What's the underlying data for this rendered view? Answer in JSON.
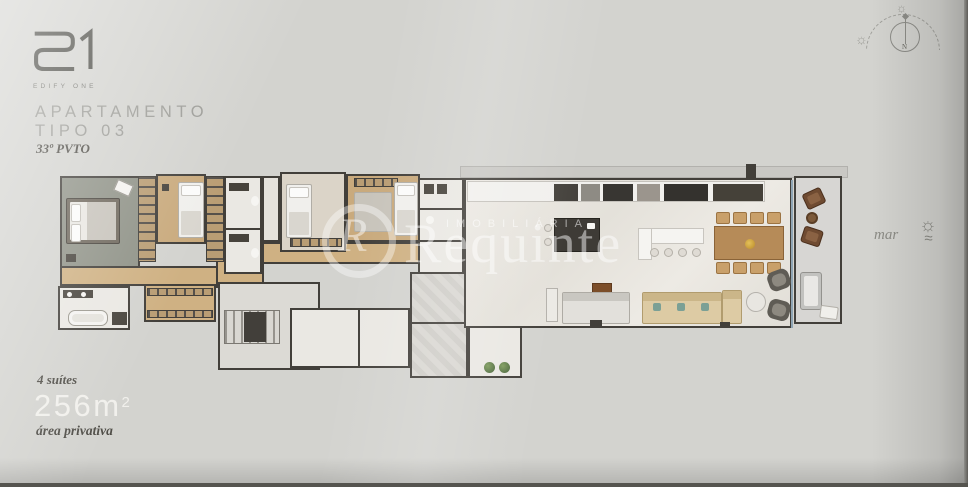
{
  "brand": {
    "mark": "E1",
    "name": "EDIFY ONE"
  },
  "header": {
    "title_line1": "APARTAMENTO",
    "title_line2": "TIPO 03",
    "floor": "33º PVTO"
  },
  "specs": {
    "suites": "4 suítes",
    "area_value": "256m",
    "area_exponent": "2",
    "area_label": "área privativa"
  },
  "context": {
    "sea_label": "mar"
  },
  "compass": {
    "north": "N"
  },
  "icons": {
    "sun": "☼",
    "waves": "≈"
  },
  "watermark": {
    "monogram": "R",
    "tagline": "IMOBILIÁRIA",
    "name": "Requinte"
  },
  "palette": {
    "background": "#d3d3cf",
    "wall": "#423f3a",
    "wood_floor": "#c9aa7d",
    "corridor_wood": "#cfb183",
    "master_floor": "#8f9287",
    "tile_floor": "#eae8e3",
    "marble_floor": "#e9e6e0",
    "balcony_floor": "#d7d6d3",
    "sofa_beige": "#ddcba4",
    "chair_tan": "#c9a06a",
    "dining_wood": "#b68b58",
    "balcony_brown": "#6f4b31",
    "plant_green": "#46613a",
    "glass_blue": "#8fa5b4"
  }
}
